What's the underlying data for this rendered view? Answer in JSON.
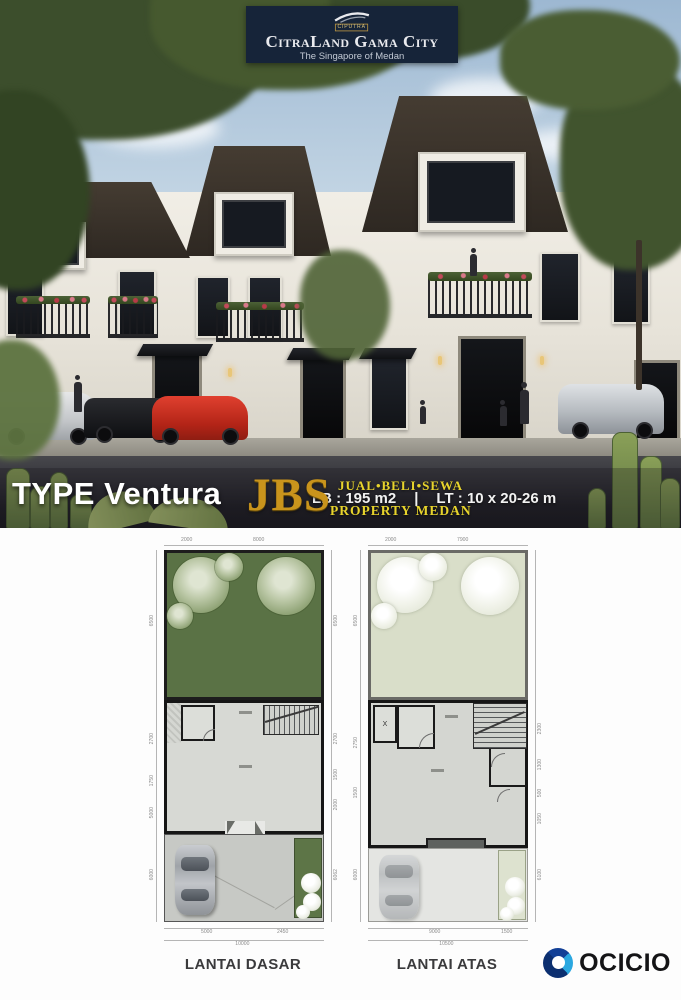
{
  "header": {
    "logo_mark": "CIPUTRA",
    "title": "CitraLand Gama City",
    "tagline": "The Singapore of Medan"
  },
  "hero": {
    "type_label": "TYPE Ventura",
    "specs": {
      "lb": "LB : 195 m2",
      "sep": "|",
      "lt": "LT : 10 x 20-26 m"
    },
    "watermark": {
      "name": "JBS",
      "top": "JUAL•BELI•SEWA",
      "bottom": "PROPERTY MEDAN"
    }
  },
  "plans": {
    "ground": {
      "label": "LANTAI DASAR",
      "dims_top": [
        "2000",
        "8000"
      ],
      "dims_left": [
        "6500",
        "2700",
        "1750",
        "5000",
        "6000"
      ],
      "dims_right": [
        "6500",
        "2700",
        "1500",
        "2000",
        "6062"
      ],
      "dims_bottom": [
        "5000",
        "2450"
      ],
      "dim_total": "10000"
    },
    "upper": {
      "label": "LANTAI ATAS",
      "dims_top": [
        "2000",
        "7900"
      ],
      "dims_left": [
        "6500",
        "2750",
        "1500",
        "6000"
      ],
      "dims_right": [
        "2300",
        "1300",
        "500",
        "1050",
        "6100"
      ],
      "dims_bottom": [
        "9000",
        "1500"
      ],
      "dim_total": "10500",
      "bath_mark": "X"
    }
  },
  "footer": {
    "brand": "OCICIO"
  },
  "colors": {
    "banner_navy": "#162439",
    "watermark_gold": "#c9941c",
    "watermark_yellow": "#e8d42c",
    "garden_green": "#5a7245",
    "upper_garden": "#d9dec9",
    "plan_floor_gray": "#d7d9d4",
    "ocicio_blue": "#1450b4",
    "roof_brown": "#352e27"
  }
}
